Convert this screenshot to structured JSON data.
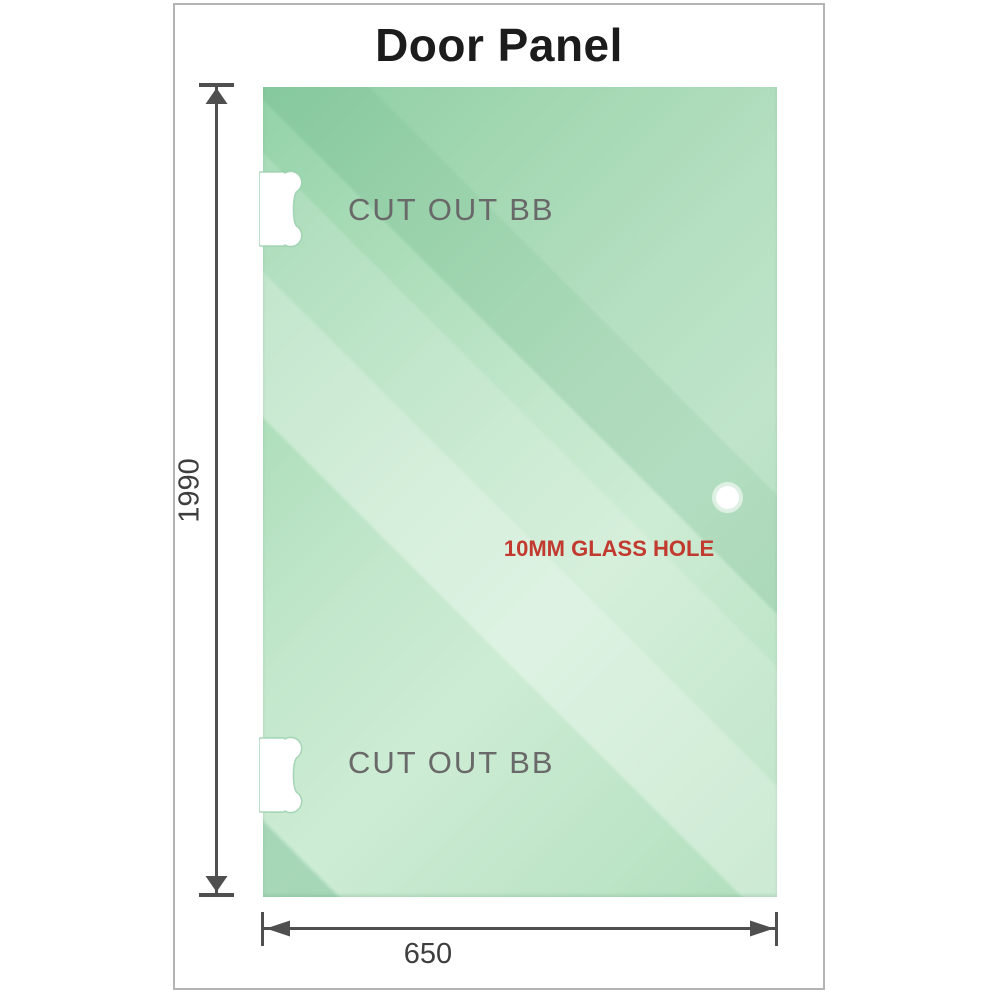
{
  "title": "Door Panel",
  "panel": {
    "cutout_top_label": "CUT OUT BB",
    "cutout_bottom_label": "CUT OUT BB",
    "hole_label": "10MM GLASS HOLE"
  },
  "dimensions": {
    "height_label": "1990",
    "width_label": "650"
  },
  "colors": {
    "glass_green_dark": "#93d2a8",
    "glass_green_light": "#cdecd4",
    "dimension_gray": "#4f4f4f",
    "label_gray": "#696969",
    "hole_label_red": "#c2392f",
    "frame_border": "#b4b4b4"
  }
}
